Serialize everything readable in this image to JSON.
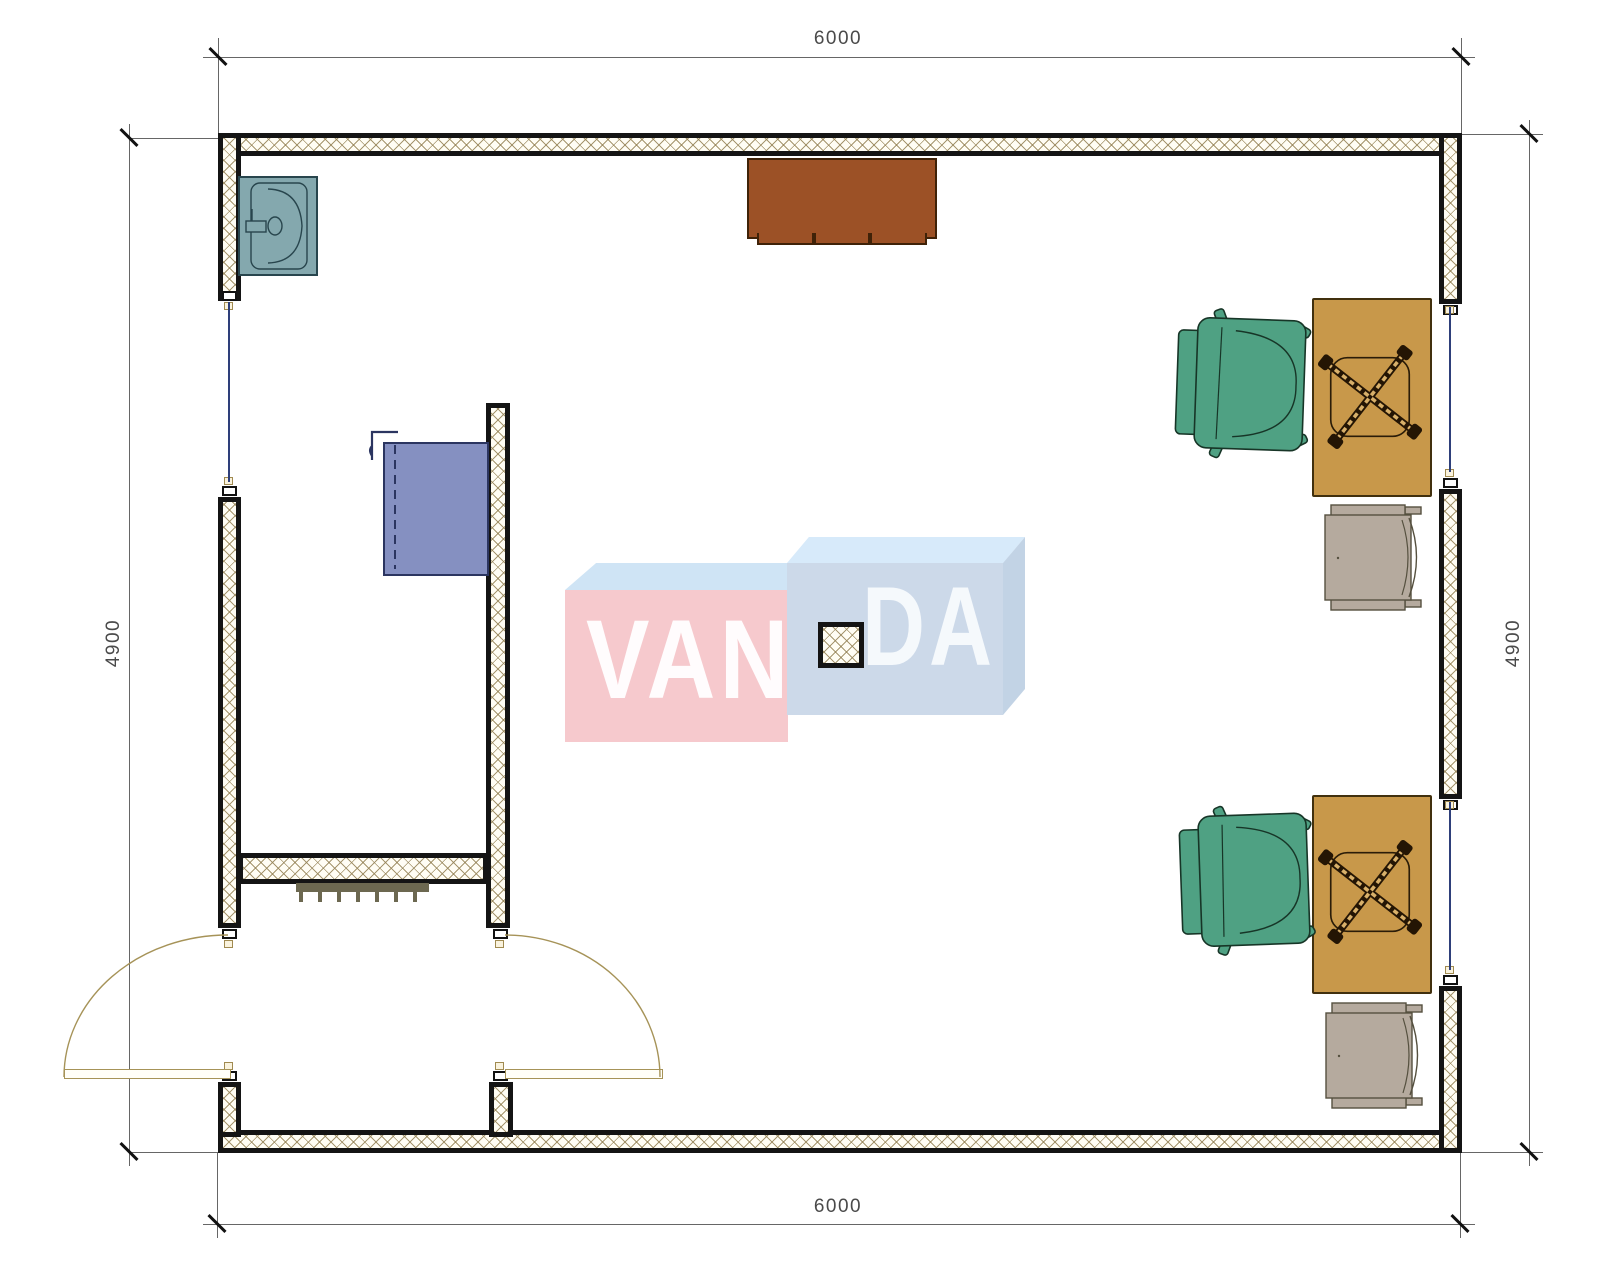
{
  "dimensions": {
    "top": "6000",
    "bottom": "6000",
    "left": "4900",
    "right": "4900"
  },
  "watermark": {
    "left_text": "VAN",
    "right_text": "DA"
  },
  "icons": {
    "sink": "sink-top-view-icon",
    "cabinet": "cabinet-top-view-icon",
    "desk_chair_base": "chair-cross-base-icon",
    "office_chair": "office-chair-top-view-icon",
    "armchair": "armchair-top-view-icon",
    "radiator": "radiator-icon",
    "door_swing": "door-swing-arc-icon",
    "window": "window-glass-icon",
    "column": "structural-column-icon"
  },
  "colors": {
    "wallEdge": "#141414",
    "hatchLine": "rgba(150,132,88,0.85)",
    "glass": "#2e3f7a",
    "dimText": "#4a4a4a",
    "doorArc": "#a69358",
    "sink": "#84a8ae",
    "cabinet": "#8590c1",
    "tableBrown": "#9c5126",
    "desk": "#c8984a",
    "chairGreen": "#4fa183",
    "chairGray": "#b5aa9e",
    "radiator": "#6c6850",
    "wmPink": "#f6c9cd",
    "wmPinkTop": "#cfe4f5",
    "wmBlueFront": "#ccd9e9",
    "wmBlueTop": "#d7eafa",
    "wmBlueSide": "#c2d3e5"
  }
}
